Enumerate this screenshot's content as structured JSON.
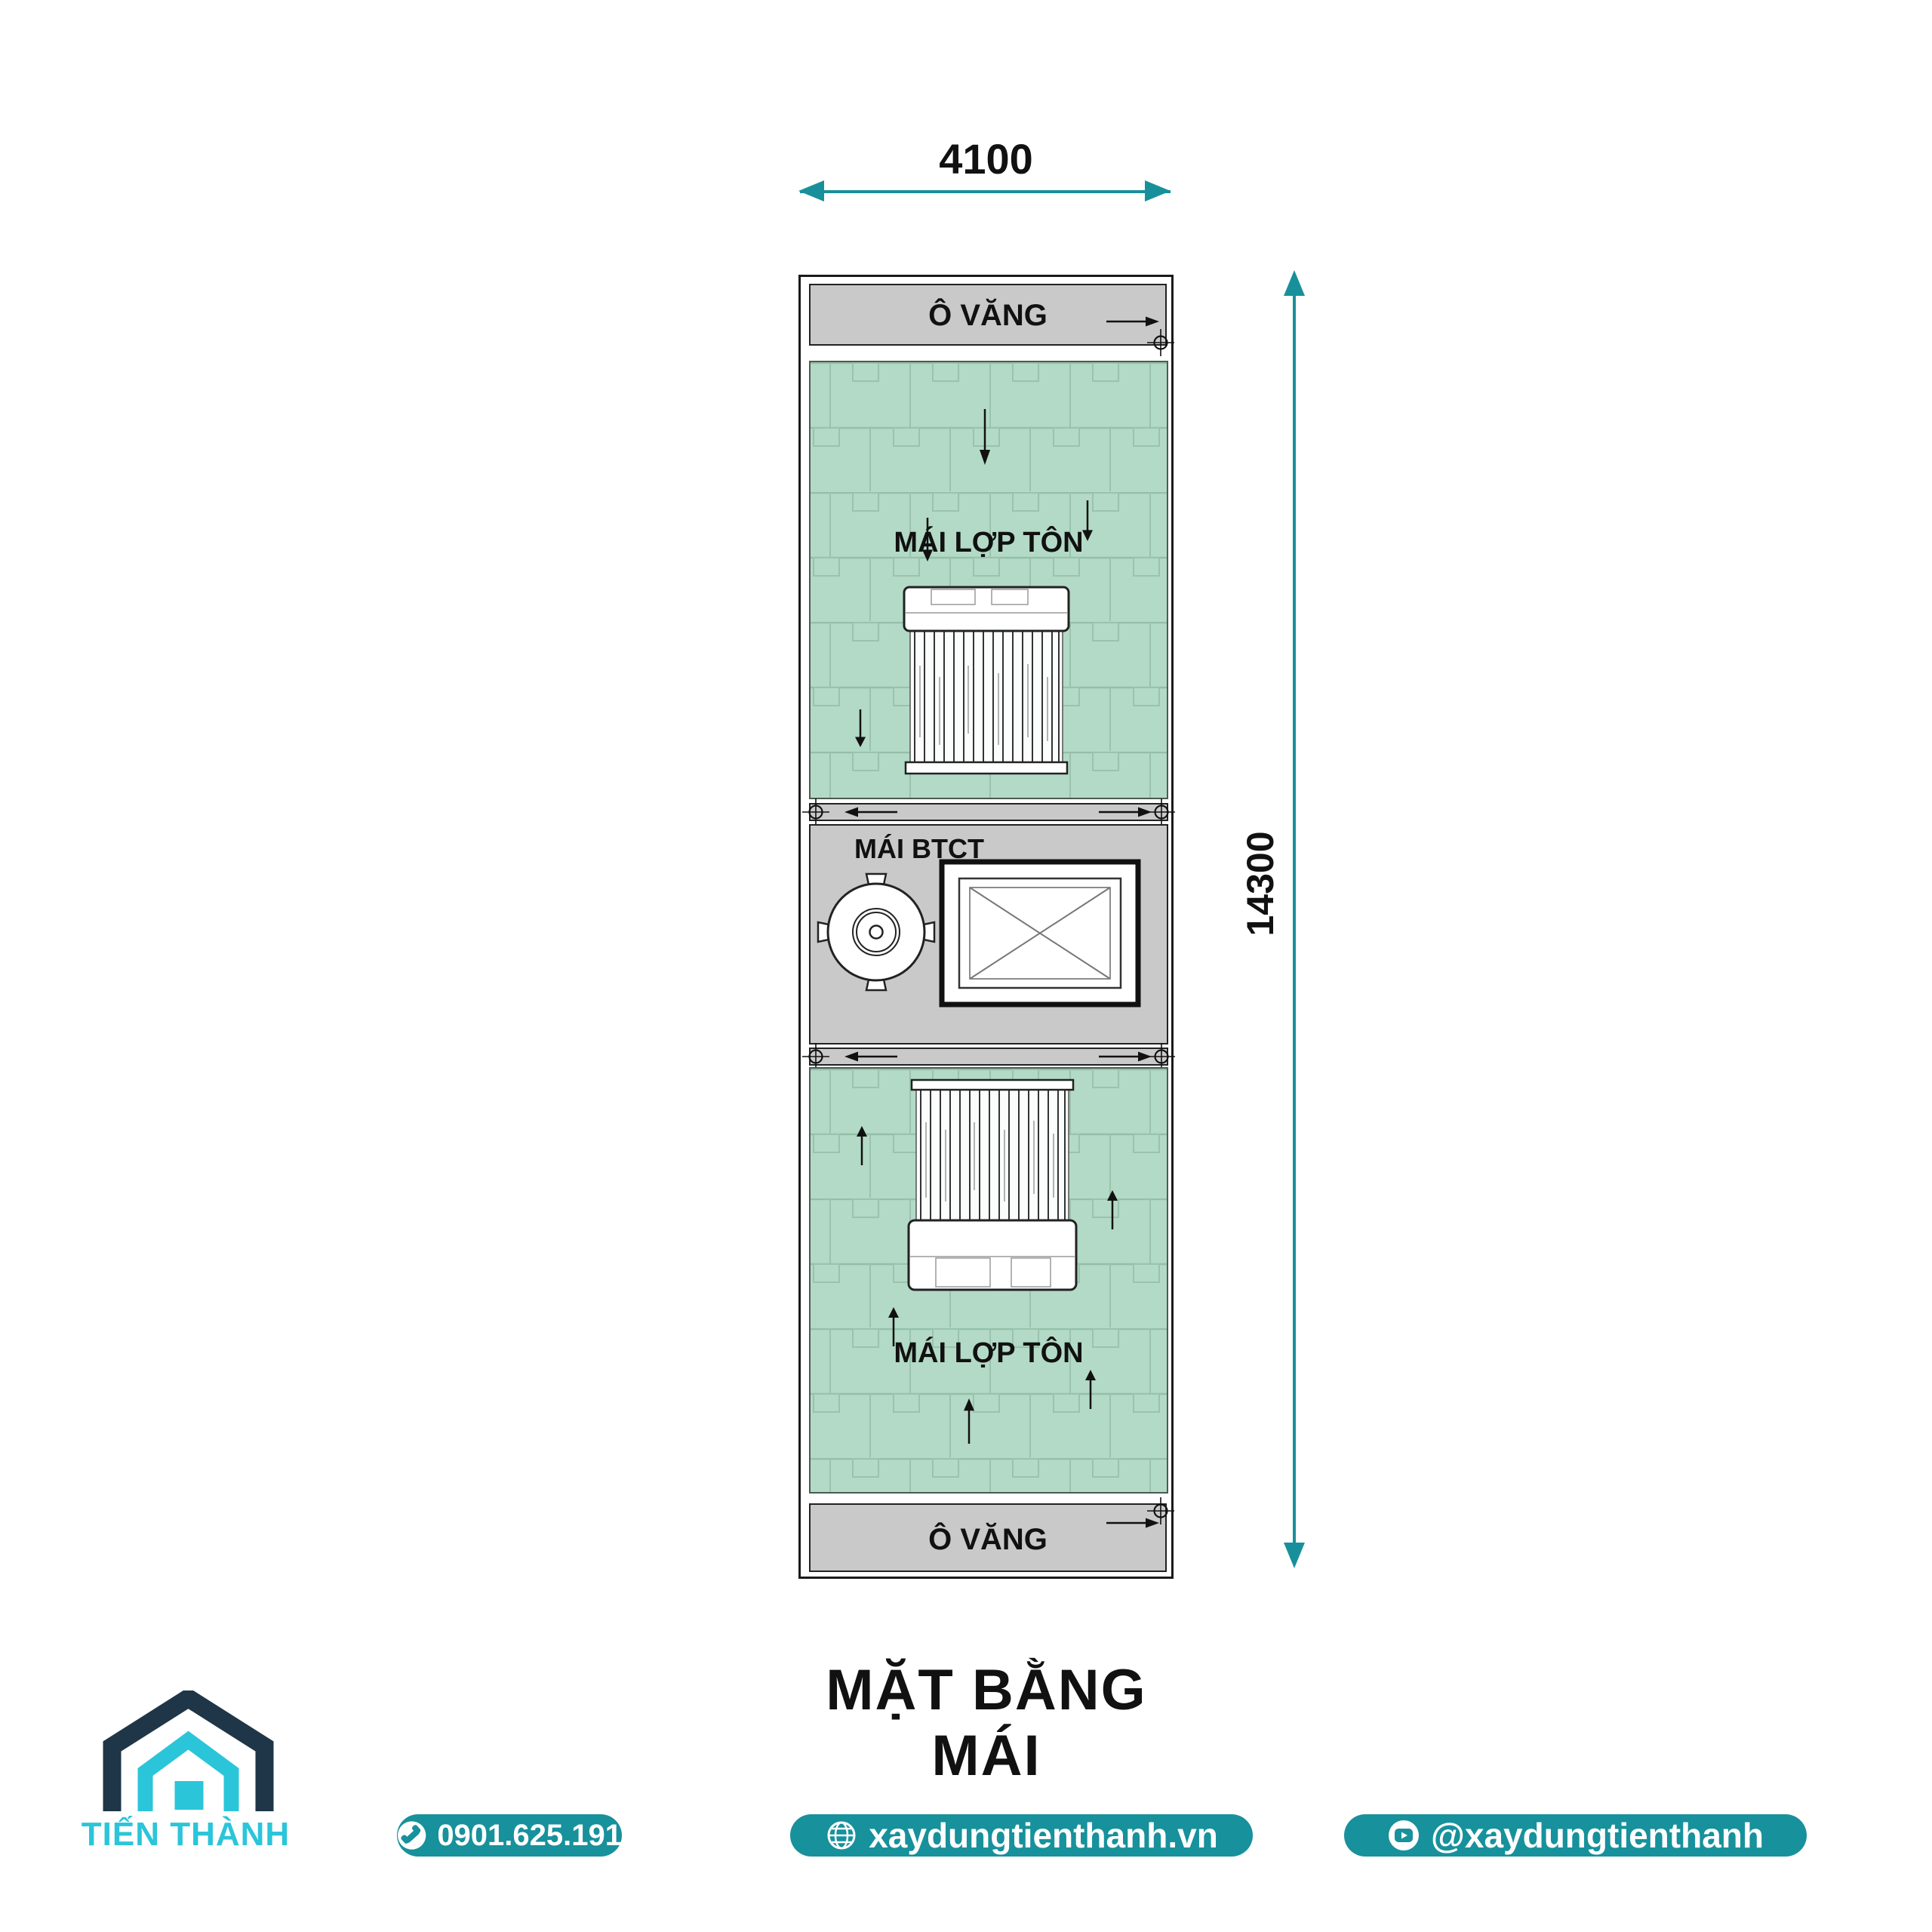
{
  "dimensions": {
    "width_label": "4100",
    "height_label": "14300"
  },
  "plan": {
    "awning_top_label": "Ô VĂNG",
    "awning_bottom_label": "Ô VĂNG",
    "roof_top_label": "MÁI LỢP TÔN",
    "roof_bottom_label": "MÁI LỢP TÔN",
    "concrete_roof_label": "MÁI BTCT"
  },
  "title": {
    "text": "MẶT BẰNG MÁI"
  },
  "footer": {
    "company": "TIẾN THÀNH",
    "phone": "0901.625.191",
    "website": "xaydungtienthanh.vn",
    "social": "@xaydungtienthanh"
  },
  "colors": {
    "accent_teal": "#18909b",
    "pill_teal": "#17919c",
    "roof_green": "#b3dac6",
    "roof_seam": "#97c1ab",
    "concrete_gray": "#c9c9c9",
    "logo_navy": "#1e3647",
    "logo_cyan": "#2bc5d9",
    "line_black": "#111111"
  },
  "icons": {
    "phone": "phone-icon",
    "website": "globe-icon",
    "social": "youtube-icon",
    "logo": "house-logo-icon",
    "plan_markers": [
      "crosshair-icon",
      "flow-arrow-icon"
    ]
  }
}
